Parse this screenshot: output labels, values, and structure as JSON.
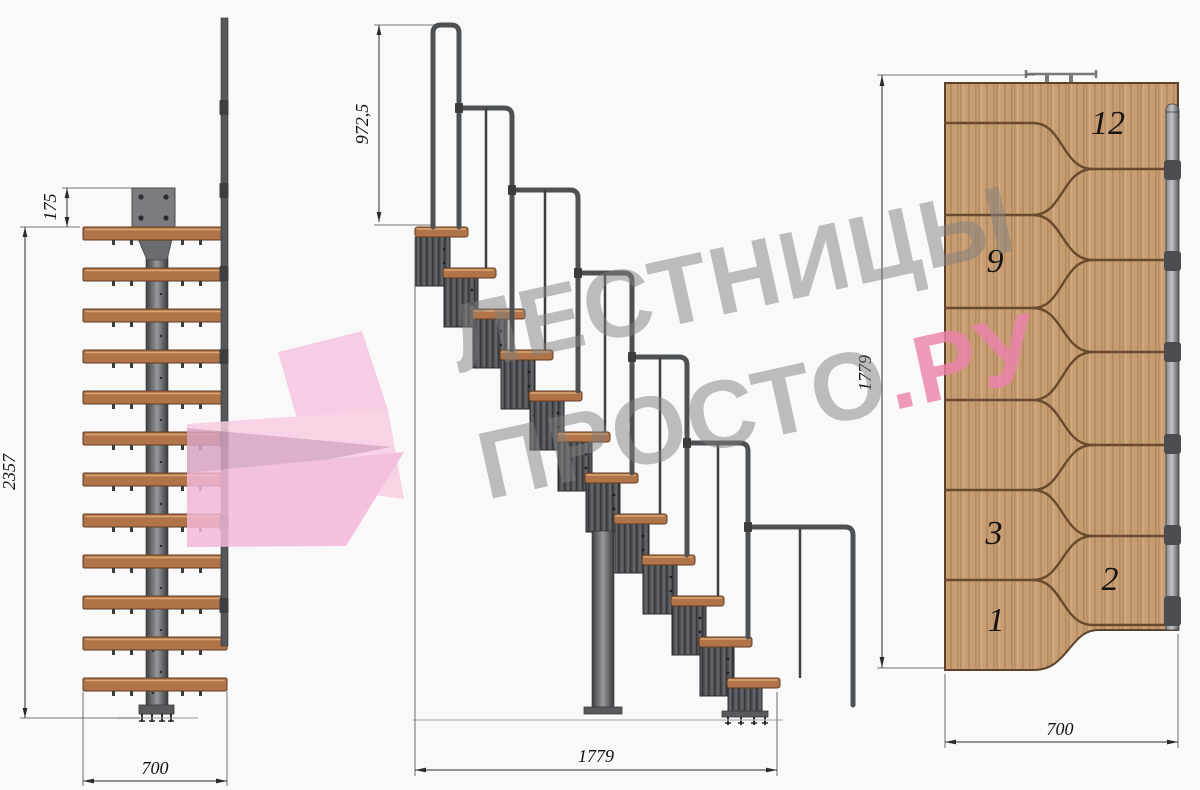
{
  "drawing": {
    "front_view": {
      "dim_offset": "175",
      "dim_height": "2357",
      "dim_width": "700"
    },
    "side_view": {
      "dim_rail_height": "972,5",
      "dim_run": "1779"
    },
    "plan_view": {
      "dim_run": "1779",
      "dim_width": "700",
      "step_labels": {
        "s12": "12",
        "s9": "9",
        "s3": "3",
        "s2": "2",
        "s1": "1"
      }
    }
  },
  "watermark": {
    "line1": "ЛЕСТНИЦЫ",
    "line2_gray": "ПРОСТО",
    "line2_pink": ".РУ",
    "brand_gray": "#7f7f7f",
    "brand_pink": "#ec82ac"
  },
  "colors": {
    "background": "#f9f9fa",
    "wood_side": "#b17449",
    "wood_plan": "#c79d73",
    "metal_dark": "#48494b",
    "dimension_ink": "#2b2b2b"
  }
}
